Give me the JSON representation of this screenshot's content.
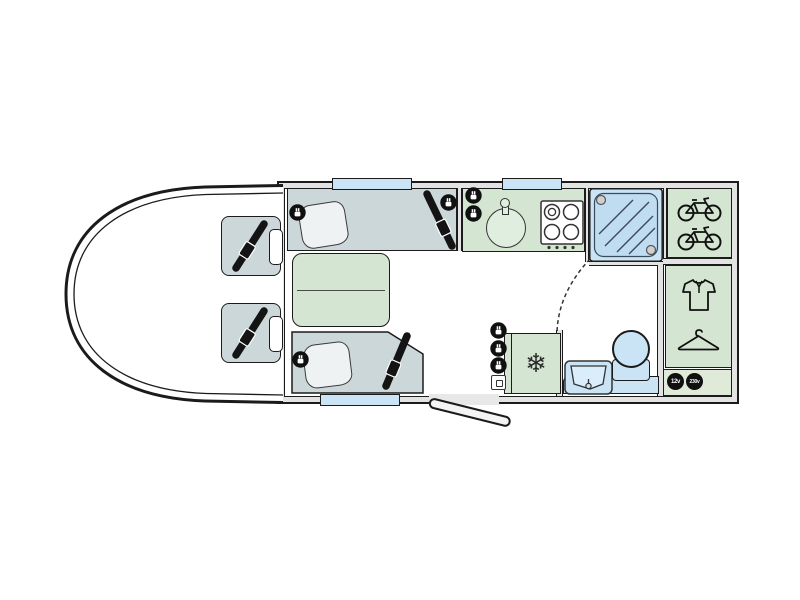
{
  "app": {
    "name": "Motorhome floorplan",
    "view": "top-down layout diagram"
  },
  "labels": {
    "socket_12v": "12v",
    "socket_230v": "230v"
  },
  "icons": {
    "fridge_snowflake": "❄",
    "list": [
      "seatbelt-icon",
      "power-socket-icon",
      "usb-socket-icon",
      "bicycle-icon",
      "shirt-icon",
      "hanger-icon",
      "snowflake-icon",
      "shower-icon",
      "hob-icon",
      "sink-icon",
      "toilet-icon",
      "washbasin-icon",
      "pillow-icon",
      "microwave-icon"
    ]
  },
  "features": [
    "cab",
    "cab-seat-upper",
    "cab-seat-lower",
    "front-lounge-bench",
    "rear-lounge-bench",
    "lounge-table",
    "kitchen-counter",
    "kitchen-sink",
    "hob-4-burner",
    "shower-cubicle",
    "bike-garage",
    "wardrobe",
    "fridge",
    "washroom",
    "washbasin",
    "toilet",
    "entrance-door",
    "window-front-lounge",
    "window-kitchen",
    "window-rear-lounge",
    "socket-panel-12v-230v"
  ],
  "colors": {
    "line": "#1b1b1b",
    "wall": "#e3e3e3",
    "floor": "#ffffff",
    "seat": "#ccd7d9",
    "green": "#d4e6d2",
    "blue": "#cae4f6",
    "blue_deep": "#c0dcf1",
    "icon_black": "#101010"
  }
}
